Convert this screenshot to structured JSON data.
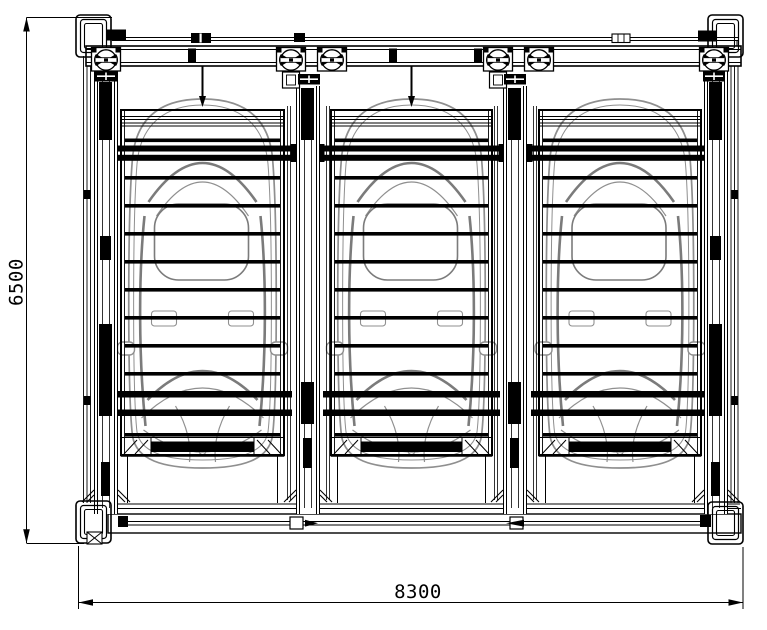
{
  "drawing": {
    "dimension_height_label": "6500",
    "dimension_width_label": "8300",
    "bay_count": 3,
    "car_count": 3
  },
  "colors": {
    "line": "#000000",
    "car": "#8f8f8f",
    "car_dark": "#7b7b7b",
    "background": "#ffffff"
  }
}
